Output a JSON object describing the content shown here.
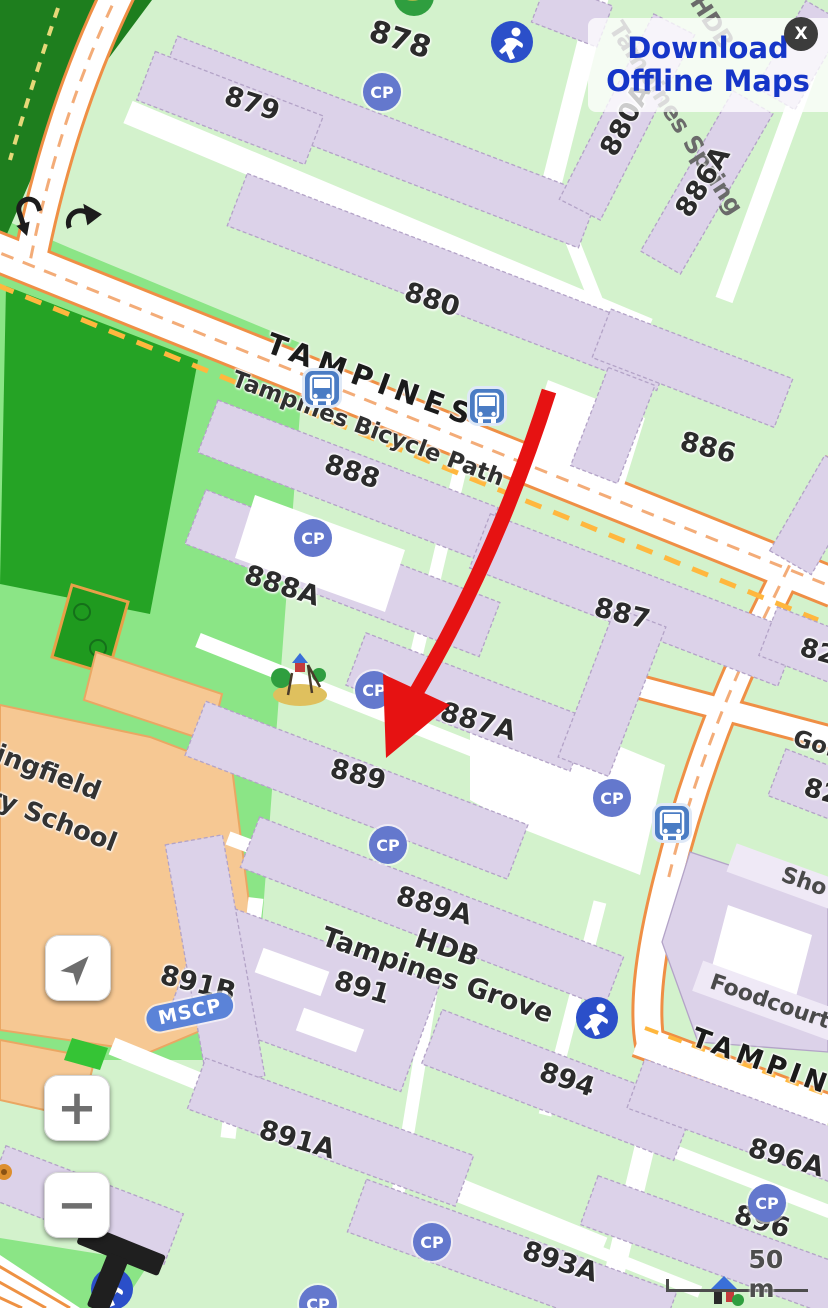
{
  "ui": {
    "offline_panel": {
      "line1": "Download",
      "line2": "Offline Maps",
      "close": "X"
    },
    "controls": {
      "zoom_in": "+",
      "zoom_out": "−"
    },
    "scale": "50 m"
  },
  "map": {
    "cp": "CP",
    "mscp": "MSCP",
    "blocks": [
      "878",
      "879",
      "880",
      "880A",
      "886A",
      "886",
      "888",
      "888A",
      "887",
      "887A",
      "889",
      "889A",
      "891",
      "891B",
      "891A",
      "893A",
      "894",
      "896",
      "896A",
      "82",
      "82"
    ],
    "streets": [
      "TAMPINES",
      "Tampines Bicycle Path",
      "TAMPINES",
      "Gol"
    ],
    "areas": {
      "estate_line1": "HDB",
      "estate_line2": "Tampines Grove",
      "spring_line1": "HDB",
      "spring_line2": "Tampines Spring",
      "school_line1": "ingfield",
      "school_line2": "ry School",
      "shops": "Sho",
      "foodcourt": "Foodcourt"
    }
  },
  "colors": {
    "accent_blue": "#1535c8",
    "arrow_red": "#e61212",
    "building_fill": "#dcd2e9",
    "road_casing": "#ef8f45",
    "bike_dash": "#ffb73e",
    "cp_blue": "#6478cd",
    "bus_blue": "#4a7cc4",
    "forest_green": "#1e7e1e",
    "field_green": "#25a325",
    "school_tan": "#f6c893"
  }
}
